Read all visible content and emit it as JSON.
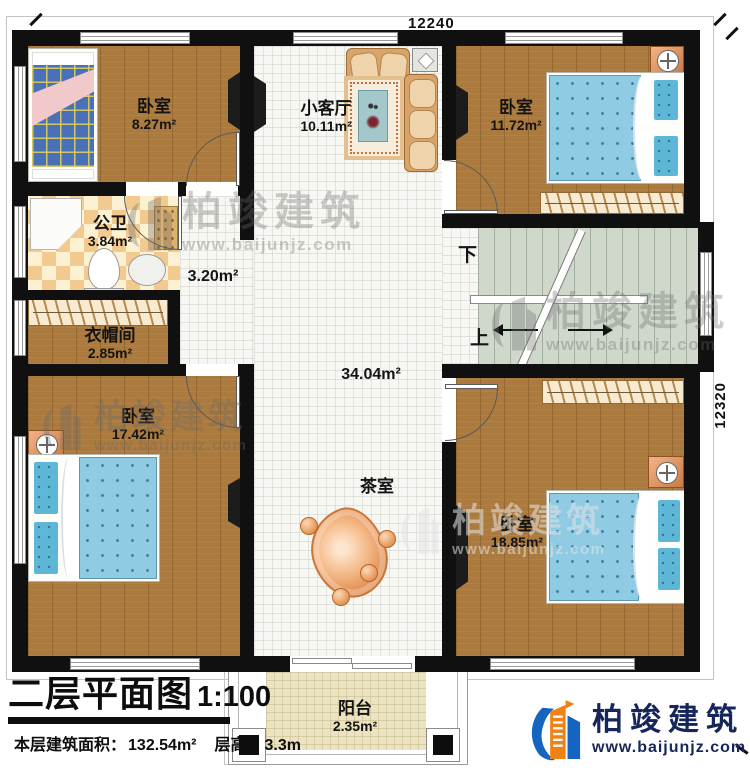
{
  "plan": {
    "dimension_top": "12240",
    "dimension_right": "12320",
    "rooms": {
      "bedroom_tl": {
        "name": "卧室",
        "area": "8.27m²"
      },
      "living": {
        "name": "小客厅",
        "area": "10.11m²"
      },
      "bedroom_tr": {
        "name": "卧室",
        "area": "11.72m²"
      },
      "bathroom": {
        "name": "公卫",
        "area": "3.84m²"
      },
      "corridor": {
        "area": "3.20m²"
      },
      "cloakroom": {
        "name": "衣帽间",
        "area": "2.85m²"
      },
      "bedroom_bl": {
        "name": "卧室",
        "area": "17.42m²"
      },
      "hall": {
        "area": "34.04m²"
      },
      "tearoom": {
        "name": "茶室"
      },
      "bedroom_br": {
        "name": "卧室",
        "area": "18.85m²"
      },
      "balcony": {
        "name": "阳台",
        "area": "2.35m²"
      }
    },
    "stairs": {
      "down_label": "下",
      "up_label": "上"
    }
  },
  "title_block": {
    "title": "二层平面图",
    "scale": "1:100",
    "area_label": "本层建筑面积：",
    "area_value": "132.54m²",
    "floor_height_label": "层高：",
    "floor_height_value": "3.3m"
  },
  "branding": {
    "company": "柏竣建筑",
    "website": "www.baijunjz.com"
  },
  "watermark": {
    "company": "柏竣建筑",
    "website": "www.baijunjz.com"
  },
  "colors": {
    "wall": "#101010",
    "wood_floor": "#ab7a3e",
    "tile_floor": "#f7f7f3",
    "stair_floor": "#d0d8cc",
    "balcony_floor": "#ebe3c1",
    "logo_blue": "#1464c0",
    "logo_orange": "#f08117",
    "logo_navy": "#16265a"
  }
}
